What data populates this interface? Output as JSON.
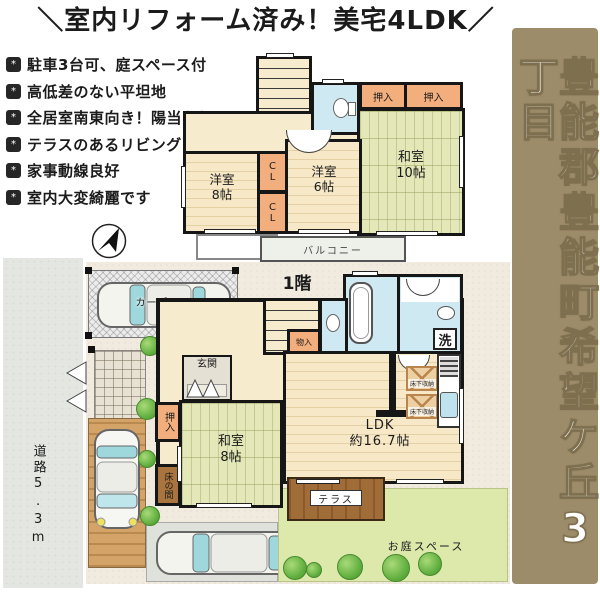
{
  "title": "＼室内リフォーム済み！美宅4LDK／",
  "features": [
    "駐車3台可、庭スペース付",
    "高低差のない平坦地",
    "全居室南東向き！陽当たり◎",
    "テラスのあるリビング",
    "家事動線良好",
    "室内大変綺麗です"
  ],
  "icons": {
    "bullet_glyph": "*",
    "compass": "north-arrow"
  },
  "banner": {
    "text": "豊能郡豊能町希望ケ丘3丁目",
    "bg_color": "#9d8c6a"
  },
  "floor2": {
    "oshiire_a": "押入",
    "oshiire_b": "押入",
    "washitsu10": "和室\n10帖",
    "yoshitsu8": "洋室\n8帖",
    "yoshitsu6": "洋室\n6帖",
    "closet_a": "C\nL",
    "closet_b": "C\nL",
    "balcony": "バルコニー"
  },
  "floor1": {
    "floor_label": "1階",
    "genkan": "玄関",
    "monoire": "物入",
    "washitsu8": "和室\n8帖",
    "oshiire": "押入",
    "tokonoma": "床の間",
    "ldk": "LDK\n約16.7帖",
    "laundry": "洗",
    "underfloor_a": "床下収納",
    "underfloor_b": "床下収納"
  },
  "site": {
    "terrace": "テラス",
    "garden": "お庭スペース",
    "carport": "カーポート",
    "road": "道路5.3m"
  },
  "colors": {
    "banner_bg": "#9d8c6a",
    "tatami": "#e4e7b8",
    "closet": "#f2ae7d",
    "water_rooms": "#cfe9f3",
    "wood_floor": "#f7e9c8",
    "terrace_wood": "#96662f",
    "garden": "#dde8ab",
    "road": "#e6e9e3",
    "site_ground": "#f1eadf"
  }
}
